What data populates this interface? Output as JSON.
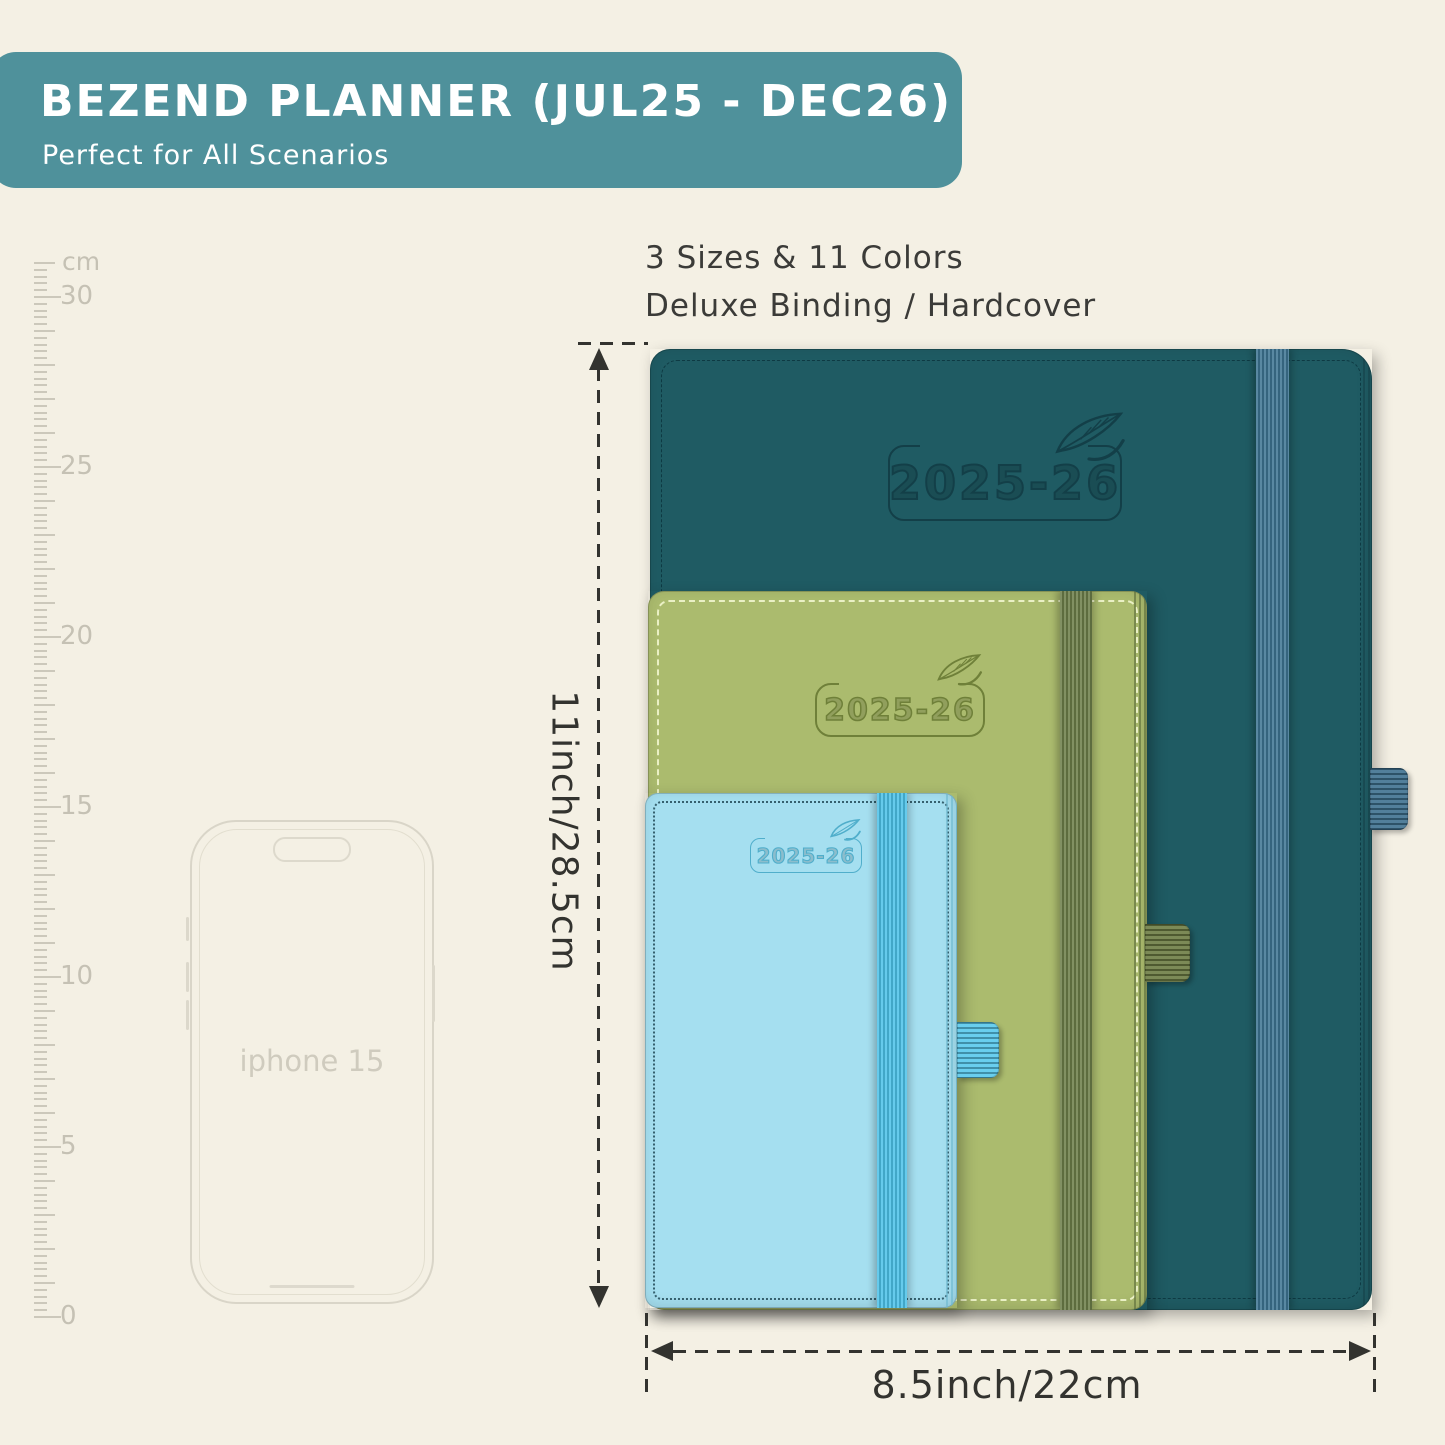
{
  "header": {
    "title": "BEZEND PLANNER (JUL25 - DEC26)",
    "subtitle": "Perfect for All Scenarios",
    "bg_color": "#4f919b",
    "text_color": "#ffffff"
  },
  "features": {
    "line1": "3 Sizes & 11 Colors",
    "line2": "Deluxe Binding / Hardcover"
  },
  "ruler": {
    "unit": "cm",
    "labels": [
      30,
      25,
      20,
      15,
      10,
      5,
      0
    ]
  },
  "phone": {
    "label": "iphone 15"
  },
  "planners": [
    {
      "size": "large",
      "label": "2025-26",
      "cover": "#1f5b63",
      "emboss": "#133f48",
      "elastic": "#3e7493",
      "stitch": "#0e3a43",
      "loop": "#3e7190",
      "ridge": "#123a42"
    },
    {
      "size": "medium",
      "label": "2025-26",
      "cover": "#abbb6e",
      "emboss": "#6f8039",
      "elastic": "#6c7e49",
      "stitch": "#eaf0c5",
      "loop": "#6d7d44",
      "ridge": "#5f6f3c"
    },
    {
      "size": "small",
      "label": "2025-26",
      "cover": "#a5dff0",
      "emboss": "#50aecb",
      "elastic": "#4dc2e9",
      "stitch": "#35606e",
      "loop": "#58c8ec",
      "ridge": "#6fb9cf"
    }
  ],
  "dimensions": {
    "height_label": "11inch/28.5cm",
    "width_label": "8.5inch/22cm",
    "line_color": "#33332f"
  }
}
